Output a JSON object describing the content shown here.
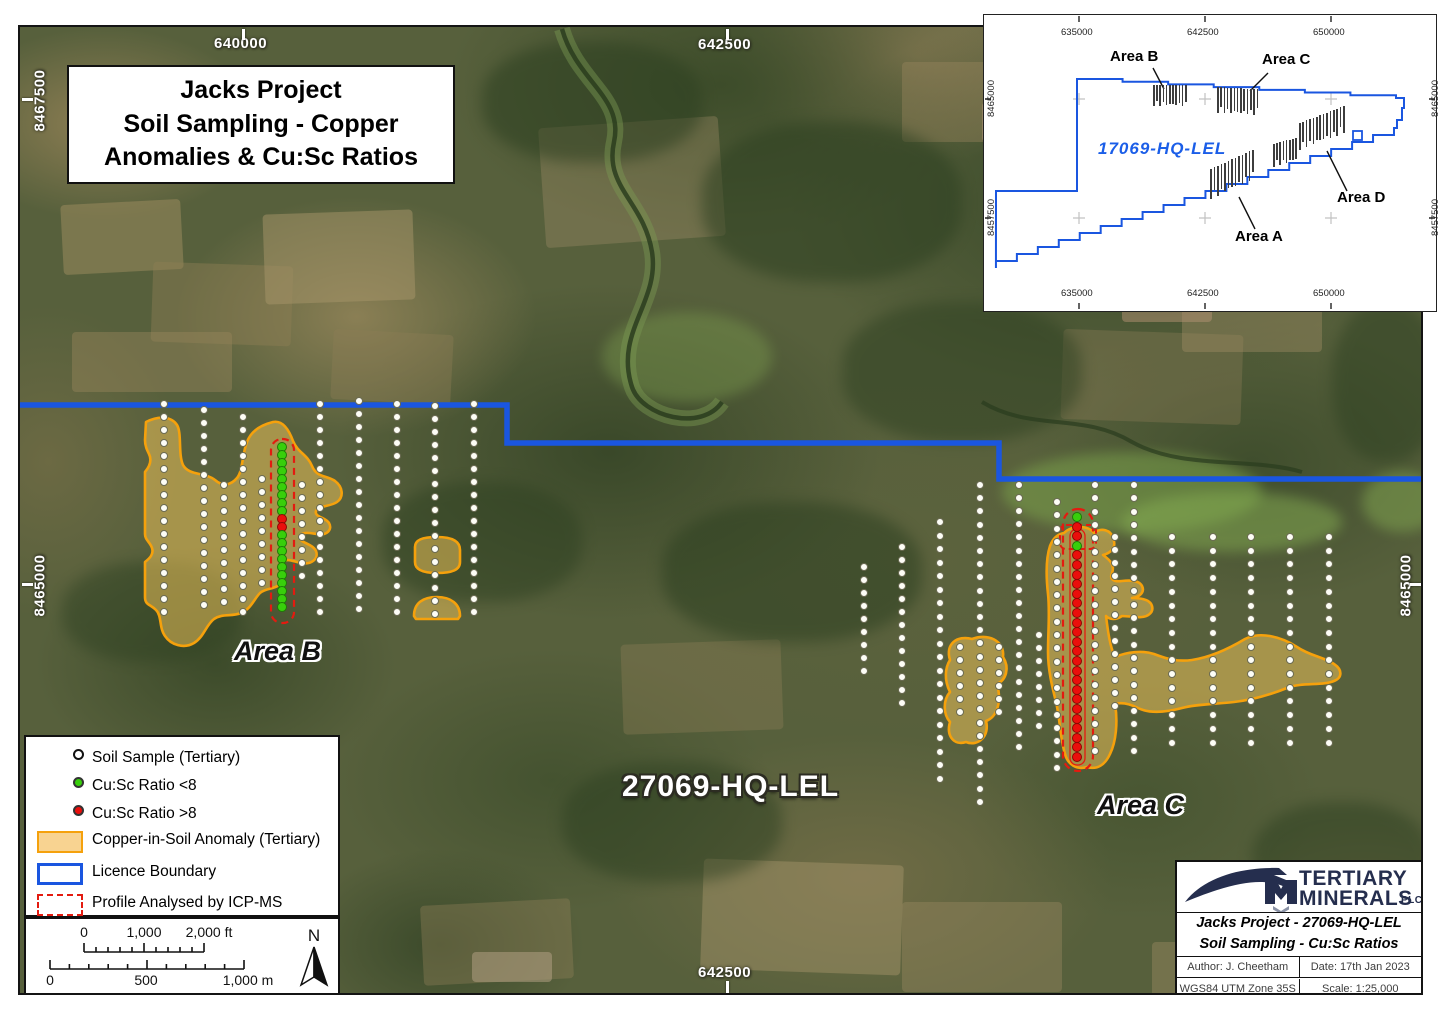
{
  "map": {
    "title_box": [
      "Jacks Project",
      "Soil Sampling - Copper",
      "Anomalies & Cu:Sc Ratios"
    ],
    "licence_label": "27069-HQ-LEL",
    "area_b_label": "Area B",
    "area_c_label": "Area C",
    "coords": {
      "top_640000": "640000",
      "top_642500": "642500",
      "left_8467500": "8467500",
      "left_8465000": "8465000",
      "right_8465000": "8465000",
      "bottom_642500": "642500"
    },
    "colors": {
      "licence_boundary": "#1a56e0",
      "anomaly_fill": "rgba(245,200,90,0.5)",
      "anomaly_stroke": "#f5a10c",
      "profile_outline": "#e31b10",
      "dot_white": "#fdfdf6",
      "dot_green": "#38cf0b",
      "dot_red": "#ea0f0c"
    },
    "sample_lines": [
      {
        "x": 162,
        "y1": 402,
        "step": 13,
        "n": 17,
        "c": "w"
      },
      {
        "x": 202,
        "y1": 408,
        "step": 13,
        "n": 16,
        "c": "w"
      },
      {
        "x": 222,
        "y1": 483,
        "step": 13,
        "n": 10,
        "c": "w"
      },
      {
        "x": 241,
        "y1": 415,
        "step": 13,
        "n": 16,
        "c": "w"
      },
      {
        "x": 260,
        "y1": 477,
        "step": 13,
        "n": 9,
        "c": "w"
      },
      {
        "x": 280,
        "y1": 445,
        "step": 8,
        "n": 21,
        "c": "gggggggggrrgggggggggg"
      },
      {
        "x": 300,
        "y1": 483,
        "step": 13,
        "n": 8,
        "c": "w"
      },
      {
        "x": 318,
        "y1": 402,
        "step": 13,
        "n": 17,
        "c": "w"
      },
      {
        "x": 357,
        "y1": 399,
        "step": 13,
        "n": 17,
        "c": "w"
      },
      {
        "x": 395,
        "y1": 402,
        "step": 13,
        "n": 17,
        "c": "w"
      },
      {
        "x": 433,
        "y1": 404,
        "step": 13,
        "n": 17,
        "c": "w"
      },
      {
        "x": 472,
        "y1": 402,
        "step": 13,
        "n": 17,
        "c": "w"
      },
      {
        "x": 862,
        "y1": 565,
        "step": 13,
        "n": 9,
        "c": "w"
      },
      {
        "x": 900,
        "y1": 545,
        "step": 13,
        "n": 13,
        "c": "w"
      },
      {
        "x": 938,
        "y1": 520,
        "step": 13.5,
        "n": 20,
        "c": "w"
      },
      {
        "x": 958,
        "y1": 645,
        "step": 13,
        "n": 6,
        "c": "w"
      },
      {
        "x": 978,
        "y1": 483,
        "step": 13.2,
        "n": 25,
        "c": "w"
      },
      {
        "x": 997,
        "y1": 645,
        "step": 13,
        "n": 6,
        "c": "w"
      },
      {
        "x": 1017,
        "y1": 483,
        "step": 13.1,
        "n": 21,
        "c": "w"
      },
      {
        "x": 1037,
        "y1": 633,
        "step": 13,
        "n": 8,
        "c": "w"
      },
      {
        "x": 1055,
        "y1": 500,
        "step": 13.3,
        "n": 21,
        "c": "w"
      },
      {
        "x": 1075,
        "y1": 515,
        "step": 9.6,
        "n": 26,
        "c": "grrgrrrrrrrrrrrrrrrrrrrrrr"
      },
      {
        "x": 1093,
        "y1": 483,
        "step": 13.3,
        "n": 21,
        "c": "w"
      },
      {
        "x": 1113,
        "y1": 535,
        "step": 13,
        "n": 14,
        "c": "w"
      },
      {
        "x": 1132,
        "y1": 483,
        "step": 13.3,
        "n": 21,
        "c": "w"
      },
      {
        "x": 1170,
        "y1": 535,
        "step": 13.7,
        "n": 16,
        "c": "w"
      },
      {
        "x": 1211,
        "y1": 535,
        "step": 13.7,
        "n": 16,
        "c": "w"
      },
      {
        "x": 1249,
        "y1": 535,
        "step": 13.7,
        "n": 16,
        "c": "w"
      },
      {
        "x": 1288,
        "y1": 535,
        "step": 13.7,
        "n": 16,
        "c": "w"
      },
      {
        "x": 1327,
        "y1": 535,
        "step": 13.7,
        "n": 16,
        "c": "w"
      }
    ]
  },
  "legend": {
    "items": [
      {
        "swatch": "circle-white",
        "label": "Soil Sample (Tertiary)"
      },
      {
        "swatch": "circle-green",
        "label": "Cu:Sc Ratio <8"
      },
      {
        "swatch": "circle-red",
        "label": "Cu:Sc Ratio >8"
      },
      {
        "swatch": "rect-orange",
        "label": "Copper-in-Soil Anomaly (Tertiary)"
      },
      {
        "swatch": "rect-blue",
        "label": "Licence Boundary"
      },
      {
        "swatch": "rect-red-dash",
        "label": "Profile Analysed by ICP-MS"
      }
    ]
  },
  "scalebar": {
    "ft": {
      "t0": "0",
      "t1": "1,000",
      "t2": "2,000 ft"
    },
    "m": {
      "t0": "0",
      "t1": "500",
      "t2": "1,000 m"
    },
    "north": "N"
  },
  "titleblock": {
    "company_line1": "TERTIARY",
    "company_line2": "MINERALS",
    "plc": "PLC",
    "title_line1": "Jacks Project - 27069-HQ-LEL",
    "title_line2": "Soil Sampling - Cu:Sc Ratios",
    "author": "Author: J. Cheetham",
    "date": "Date: 17th Jan 2023",
    "datum": "WGS84 UTM Zone 35S",
    "scale": "Scale: 1:25,000"
  },
  "inset": {
    "licence_label": "17069-HQ-LEL",
    "area_b": "Area B",
    "area_c": "Area C",
    "area_d": "Area D",
    "area_a": "Area A",
    "coords": {
      "x0": "635000",
      "x1": "642500",
      "x2": "650000",
      "y0": "8465000",
      "y1": "8457500"
    },
    "hatch_clusters": [
      {
        "x": 1152,
        "y": 84,
        "n": 11,
        "dx": 3.2,
        "len": 21,
        "slope": 0
      },
      {
        "x": 1216,
        "y": 86,
        "n": 13,
        "dx": 3.3,
        "len": 26,
        "slope": 0.2
      },
      {
        "x": 1272,
        "y": 143,
        "n": 8,
        "dx": 3.2,
        "len": 23,
        "slope": -0.9
      },
      {
        "x": 1298,
        "y": 122,
        "n": 14,
        "dx": 3.4,
        "len": 27,
        "slope": -1.3
      },
      {
        "x": 1209,
        "y": 168,
        "n": 13,
        "dx": 3.5,
        "len": 30,
        "slope": -1.6
      }
    ]
  }
}
